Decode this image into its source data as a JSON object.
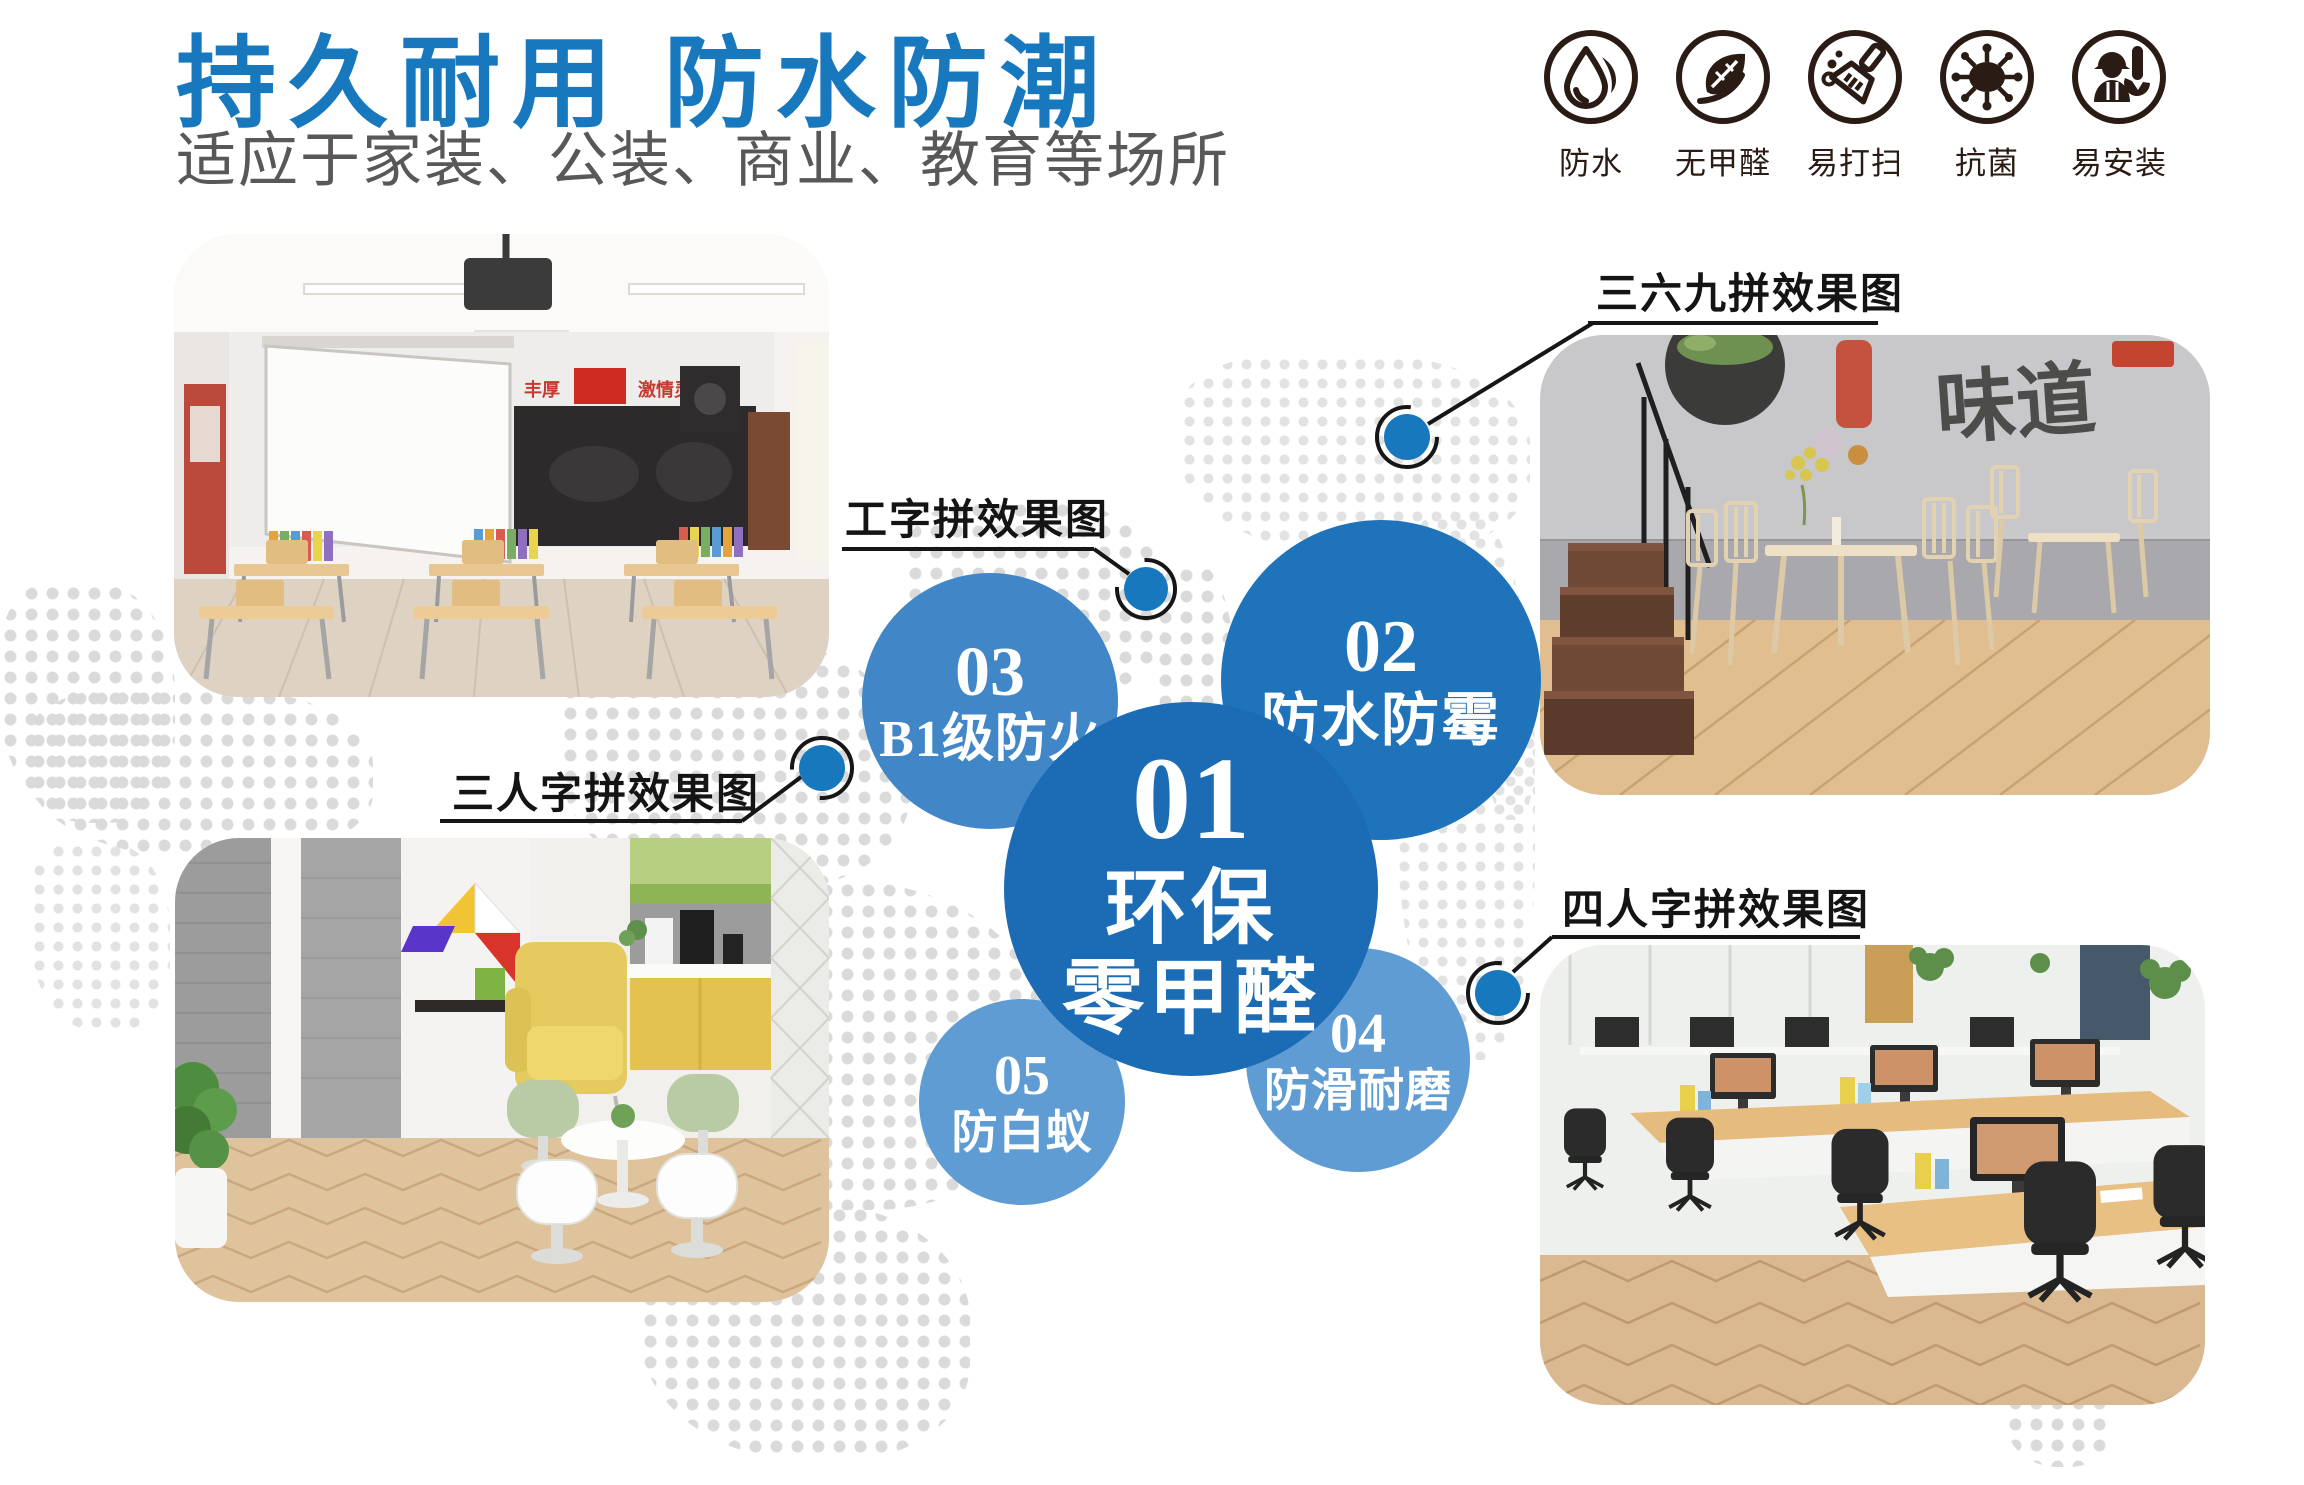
{
  "colors": {
    "accent_blue": "#1878be",
    "bubble_dark_blue": "#1b6cb5",
    "bubble_mid_blue": "#4187c7",
    "bubble_light_blue": "#5f9cd3",
    "subtitle_gray": "#595757",
    "callout_line_black": "#161616",
    "badge_icon_black": "#2a1c14",
    "dot_gray": "#dadada"
  },
  "header": {
    "title": "持久耐用 防水防潮",
    "subtitle": "适应于家装、公装、商业、教育等场所"
  },
  "badges": {
    "items": [
      {
        "icon": "waterdrop-icon",
        "label": "防水"
      },
      {
        "icon": "leaf-icon",
        "label": "无甲醛"
      },
      {
        "icon": "broom-icon",
        "label": "易打扫"
      },
      {
        "icon": "virus-icon",
        "label": "抗菌"
      },
      {
        "icon": "worker-wrench-icon",
        "label": "易安装"
      }
    ]
  },
  "bubbles": {
    "b1": {
      "number": "01",
      "line1": "环保",
      "line2": "零甲醛"
    },
    "b2": {
      "number": "02",
      "label": "防水防霉"
    },
    "b3": {
      "number": "03",
      "label": "B1级防火"
    },
    "b4": {
      "number": "04",
      "label": "防滑耐磨"
    },
    "b5": {
      "number": "05",
      "label": "防白蚁"
    }
  },
  "callouts": {
    "c1": {
      "label": "三六九拼效果图"
    },
    "c2": {
      "label": "工字拼效果图"
    },
    "c3": {
      "label": "三人字拼效果图"
    },
    "c4": {
      "label": "四人字拼效果图"
    }
  },
  "photos": {
    "classroom": {
      "banner_left": "丰厚",
      "banner_right": "激情灵动"
    },
    "restaurant": {
      "mural_text": "味道"
    }
  }
}
